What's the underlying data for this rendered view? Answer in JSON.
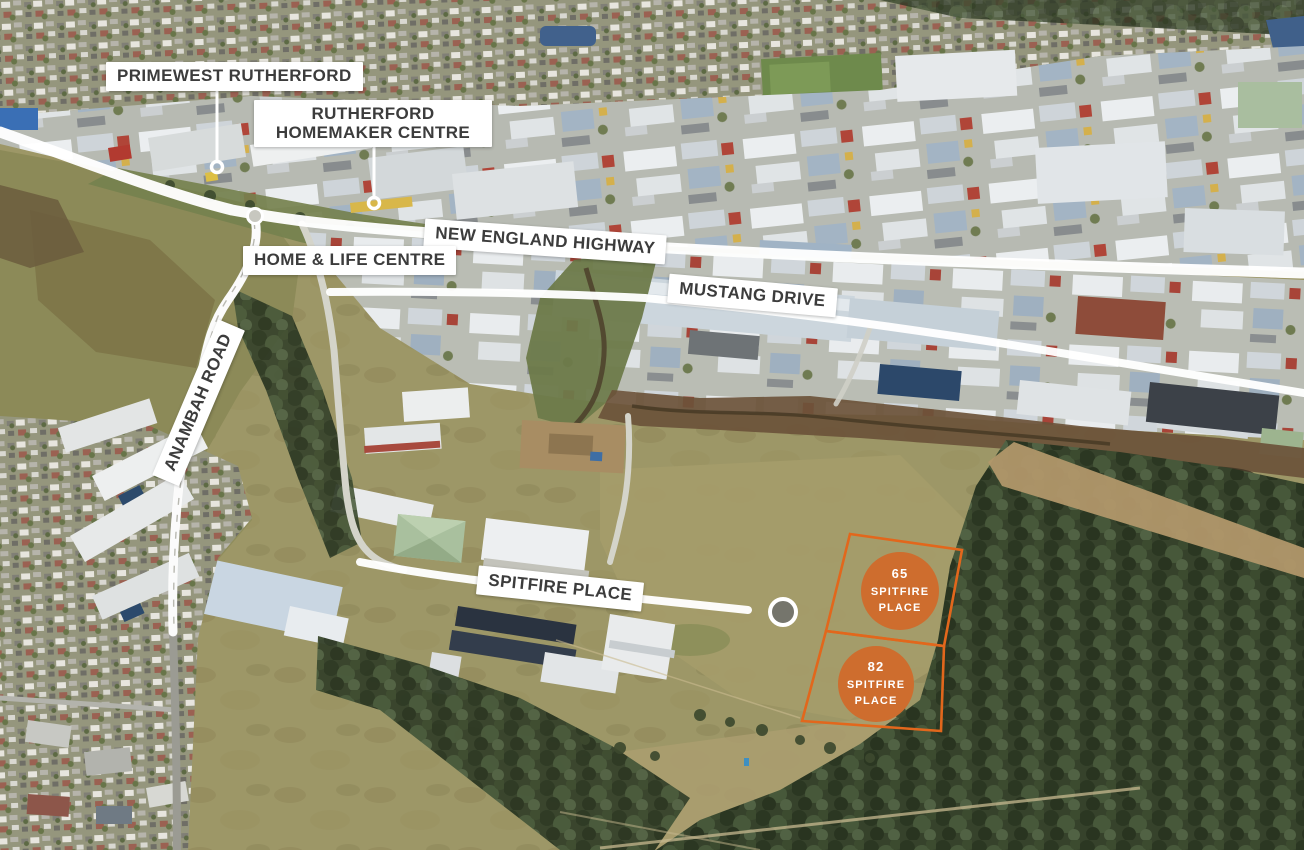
{
  "annotations": {
    "primewest": {
      "label": "PRIMEWEST RUTHERFORD"
    },
    "homemaker": {
      "label": "RUTHERFORD HOMEMAKER CENTRE"
    },
    "home_life": {
      "label": "HOME & LIFE CENTRE"
    },
    "highway": {
      "label": "NEW ENGLAND HIGHWAY"
    },
    "mustang": {
      "label": "MUSTANG DRIVE"
    },
    "anambah": {
      "label": "ANAMBAH ROAD"
    },
    "spitfire": {
      "label": "SPITFIRE PLACE"
    }
  },
  "lots": [
    {
      "number": "65",
      "street_word1": "SPITFIRE",
      "street_word2": "PLACE"
    },
    {
      "number": "82",
      "street_word1": "SPITFIRE",
      "street_word2": "PLACE"
    }
  ],
  "colors": {
    "lot_orange": "#E2671C",
    "lot_orange_fill": "#CE6D2E",
    "label_bg": "#FFFFFF",
    "label_text": "#3C3C3C",
    "road_highlight": "#FFFFFF"
  }
}
